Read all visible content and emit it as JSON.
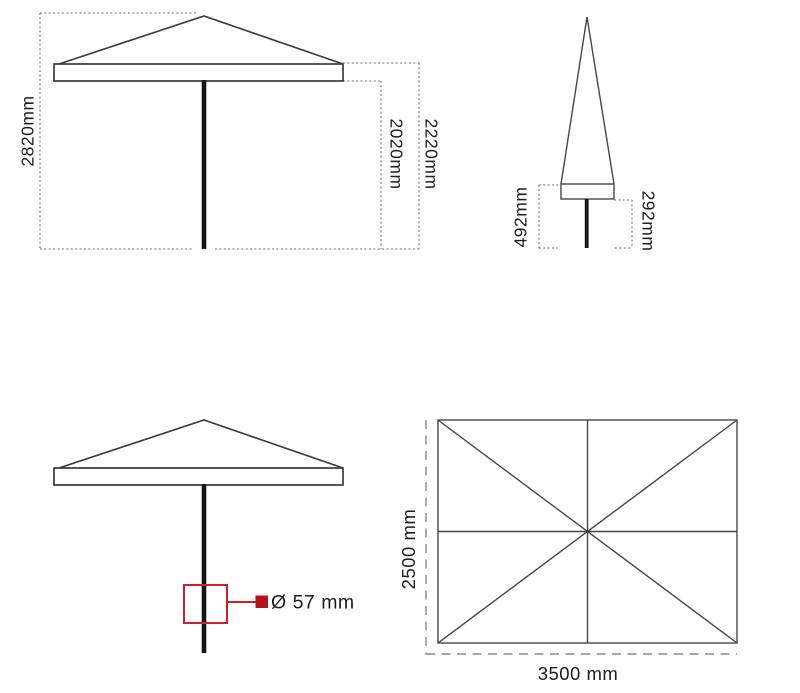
{
  "colors": {
    "drawing_line": "#3b3b3b",
    "pole": "#161616",
    "dotted_dim_line": "#808080",
    "dashed_dim_line": "#a8a8a8",
    "text": "#1c1c1c",
    "red_callout": "#cd2128",
    "red_marker_fill": "#b41319"
  },
  "views": {
    "side_open": {
      "total_height": "2820mm",
      "height_under_canopy": "2020mm",
      "height_canopy_top_edge": "2220mm"
    },
    "side_closed": {
      "canopy_to_ground": "492mm",
      "pole_exposed_height": "292mm"
    },
    "pole_detail": {
      "pole_diameter": "Ø 57 mm"
    },
    "top_view": {
      "canopy_depth": "2500 mm",
      "canopy_width": "3500 mm"
    }
  }
}
